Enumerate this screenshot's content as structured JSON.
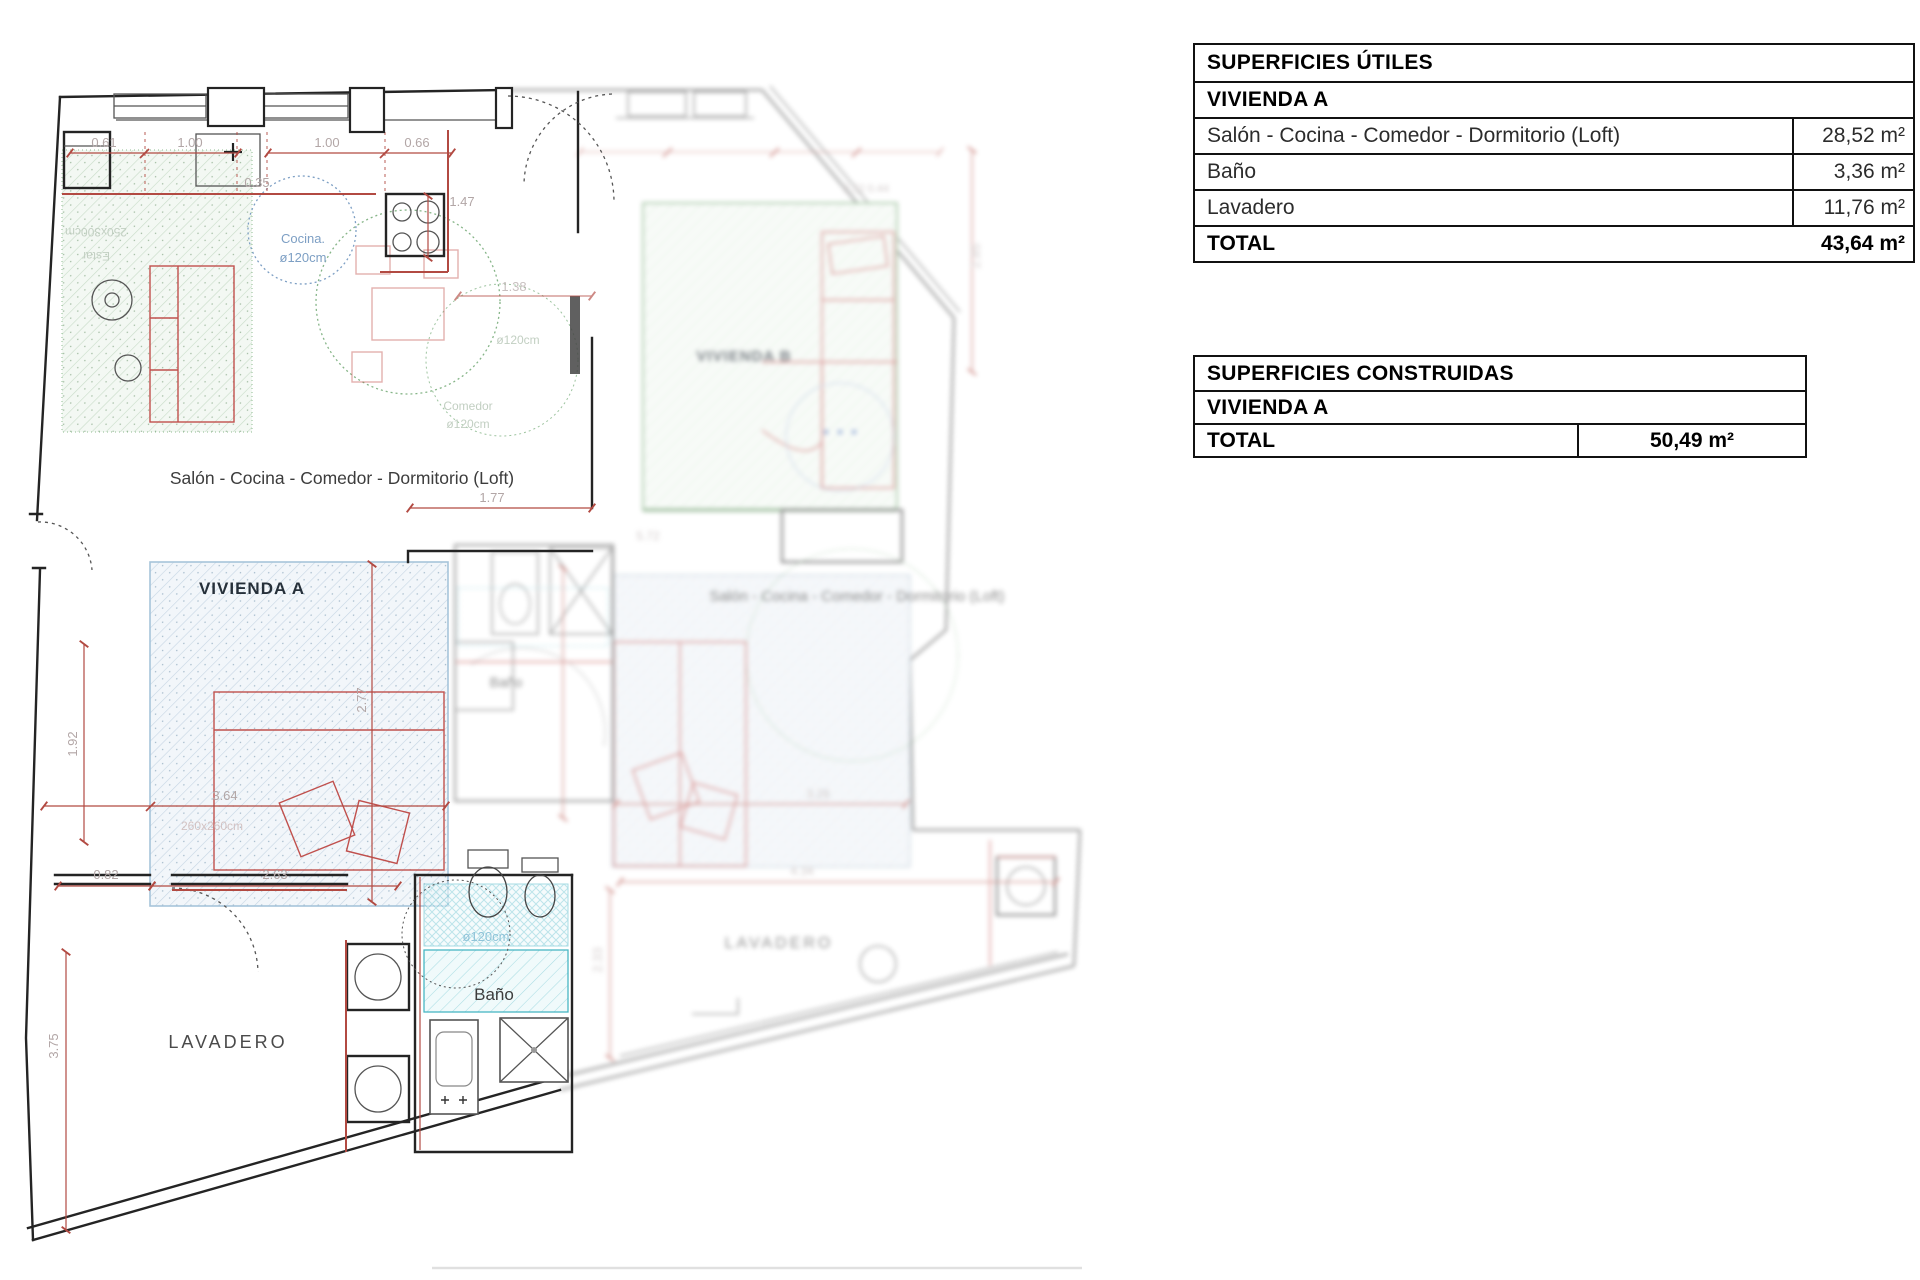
{
  "tables": {
    "utiles": {
      "title": "SUPERFICIES ÚTILES",
      "subtitle": "VIVIENDA A",
      "rows": [
        {
          "label": "Salón - Cocina - Comedor - Dormitorio (Loft)",
          "value": "28,52  m²"
        },
        {
          "label": "Baño",
          "value": "3,36  m²"
        },
        {
          "label": "Lavadero",
          "value": "11,76  m²"
        }
      ],
      "total_label": "TOTAL",
      "total_value": "43,64  m²"
    },
    "construidas": {
      "title": "SUPERFICIES CONSTRUIDAS",
      "subtitle": "VIVIENDA A",
      "total_label": "TOTAL",
      "total_value": "50,49  m²"
    }
  },
  "plan": {
    "labels": {
      "salon_a": "Salón - Cocina - Comedor - Dormitorio (Loft)",
      "vivienda_a": "VIVIENDA A",
      "lavadero_a": "LAVADERO",
      "bano_a": "Baño",
      "cocina_line1": "Cocina.",
      "cocina_line2": "ø120cm",
      "comedor_line1": "Comedor",
      "comedor_line2": "ø120cm",
      "turning_note": "ø120cm",
      "estar_line1": "250x300cm",
      "estar_line2": "Estar",
      "dorm_note": "260x260cm",
      "bano_circle": "ø120cm",
      "vivienda_b": "VIVIENDA B",
      "salon_b": "Salón - Cocina - Comedor - Dormitorio (Loft)",
      "bano_b": "Baño",
      "lavadero_b": "LAVADERO"
    },
    "dims": {
      "d061": "0.61",
      "d100a": "1.00",
      "d100b": "1.00",
      "d066": "0.66",
      "d035": "0.35",
      "d147": "1.47",
      "d138": "1.38",
      "d177": "1.77",
      "d277": "2.77",
      "d192": "1.92",
      "d364": "3.64",
      "d082": "0.82",
      "d263": "2.63",
      "d375": "3.75",
      "d285": "2.85",
      "d032": "0.32 0.44",
      "d572": "5.72",
      "d328": "3.28",
      "d233": "2.33",
      "d434": "4.34"
    },
    "colors": {
      "dim_red": "#b24a42",
      "wall": "#242424",
      "furniture_red": "#c0504d",
      "green": "#7fae7f",
      "blue": "#7d9fc4",
      "cyan": "#49b6c4"
    }
  }
}
